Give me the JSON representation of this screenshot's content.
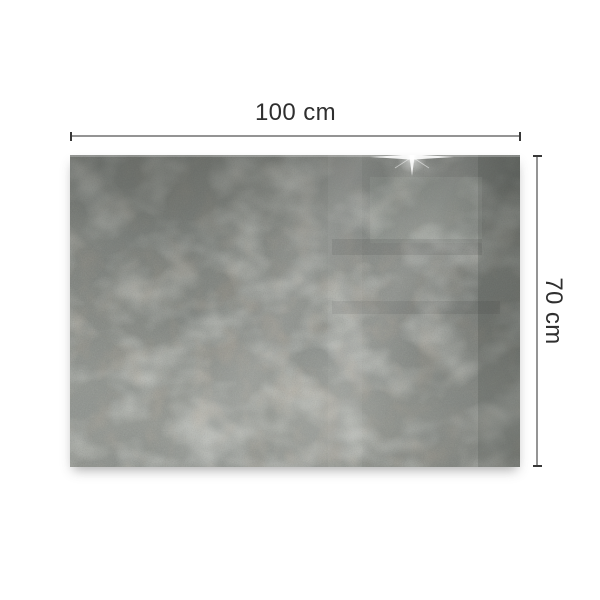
{
  "page": {
    "background_color": "#ffffff"
  },
  "annotations": {
    "width_label": "100 cm",
    "height_label": "70 cm",
    "text_color": "#2f2f2f",
    "line_color": "#949494",
    "tick_color": "#383838"
  },
  "board": {
    "alt": "concrete-look panel with glossy glass reflections",
    "base_color": "#90938e",
    "dark_shade_color": "#3f423f",
    "light_shade_color": "#b9bbb4",
    "rust_color": "#85705c",
    "right_band_color": "#2e312e",
    "icons": {
      "sparkle": "sparkle-icon"
    }
  }
}
